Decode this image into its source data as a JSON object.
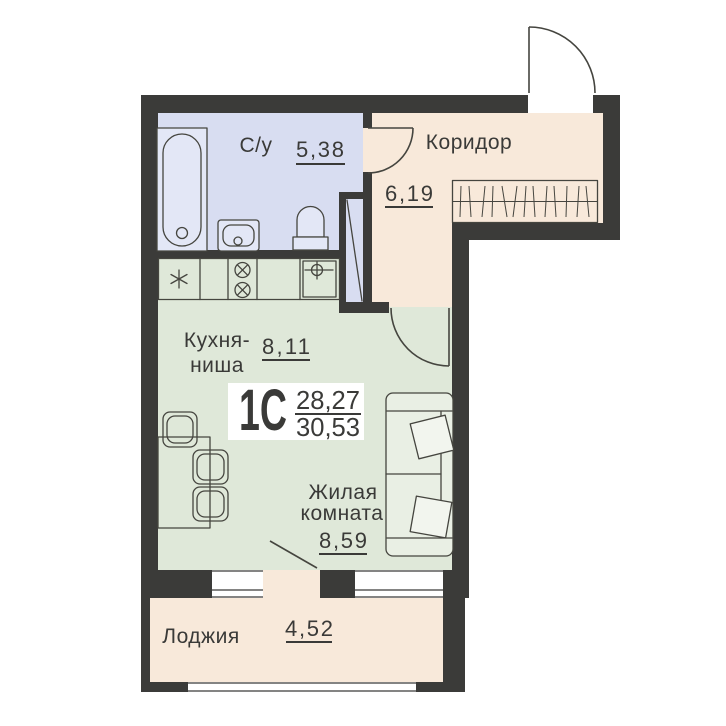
{
  "plan_code": {
    "type_label": "1С",
    "area_upper": "28,27",
    "area_lower": "30,53"
  },
  "rooms": {
    "bathroom": {
      "label": "С/у",
      "area": "5,38"
    },
    "corridor": {
      "label": "Коридор",
      "area": "6,19"
    },
    "kitchen_niche": {
      "label_line1": "Кухня-",
      "label_line2": "ниша",
      "area": "8,11"
    },
    "living_room": {
      "label_line1": "Жилая",
      "label_line2": "комната",
      "area": "8,59"
    },
    "loggia": {
      "label": "Лоджия",
      "area": "4,52"
    }
  },
  "furniture_icons": [
    "bathtub-icon",
    "washbasin-icon",
    "toilet-icon",
    "fridge-icon",
    "stove-icon",
    "kitchen-sink-icon",
    "dining-table-icon",
    "chair-icon",
    "sofa-icon",
    "pillow-icon",
    "wardrobe-icon",
    "door-swing-icon",
    "window-icon",
    "shaft-icon"
  ],
  "colors": {
    "wall": "#3b3b39",
    "bathroom": "#d8ddf1",
    "corridor": "#f8e9da",
    "room": "#dfe8d9",
    "fixture": "#e3e7f6",
    "sofa": "#e9efe4",
    "pillow": "#f2f5ee",
    "line": "#45453f",
    "text": "#3a3a38",
    "background": "#ffffff"
  }
}
